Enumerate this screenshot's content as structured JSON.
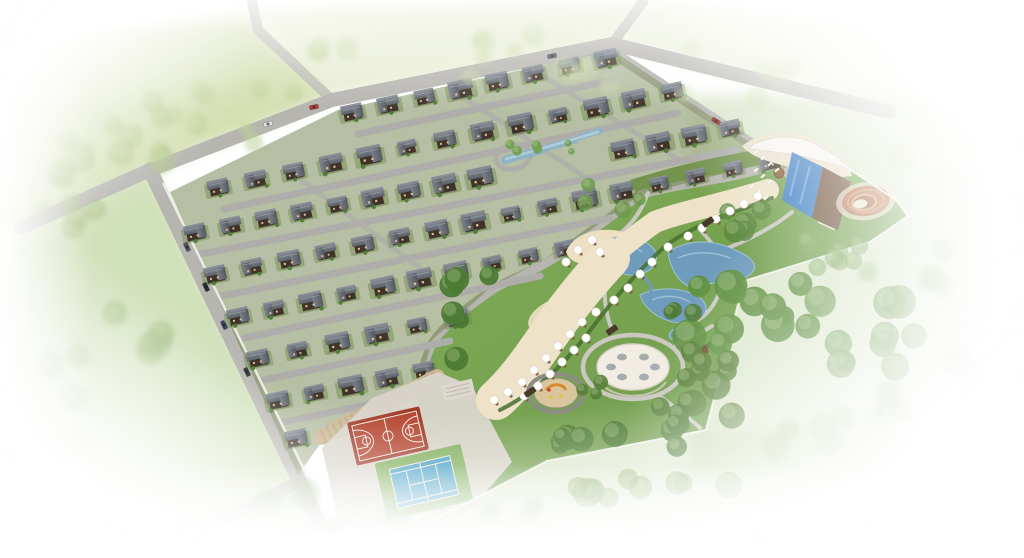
{
  "meta": {
    "title": "Aerial 3D rendering of a villa community masterplan",
    "view": "aerial-isometric",
    "description": "Gated residential estate of dark-roofed villas in diagonal rows, bounded by perimeter roads, with a landscaped park containing ponds, a sandy beach terrace with white umbrellas, a circular white plaza, a round children's playground, a swimming pool complex with wooden deck, a circular amphitheatre, a red basketball court and a blue tennis court; surrounded by green fields and tree belts fading to white at the edges."
  },
  "colors": {
    "background": "#ffffff",
    "field_green": "#ccdaa6",
    "field_green_top": "#d8e3b8",
    "meadow_green": "#aac685",
    "meadow_soft": "#b7cf92",
    "park_lawn": "#74a148",
    "park_lawn_dark": "#639140",
    "forest_green": "#5d8f3f",
    "tree_green_dark": "#4c7a33",
    "road_gray": "#b7b5b0",
    "street_gray": "#aeadaa",
    "path_gray": "#cac8c1",
    "wall_white": "#efeee8",
    "fence_white": "#f5f4ef",
    "estate_green": "#6d7f48",
    "yard_green": "#6c8a45",
    "house_body": "#3f332a",
    "window_cream": "#d8c49a",
    "roof_light": "#8e939b",
    "roof_dark": "#5c6169",
    "pond_blue": "#6f9cbd",
    "pond_blue_light": "#a9c9dc",
    "estate_pond": "#8fb3c6",
    "pool_blue": "#3e7ec2",
    "pool_lane": "#7db3e2",
    "deck_wood": "#6f5138",
    "deck_cream": "#ece2cc",
    "building_white": "#f6f4ee",
    "terrace_cream": "#eee3c8",
    "hedge_green": "#47702f",
    "sand_cream": "#ecdfc2",
    "court_red": "#b4432e",
    "court_red_dark": "#a23a28",
    "court_line": "#f2ece2",
    "tennis_blue": "#3f9dc4",
    "tennis_green": "#7fae5a",
    "platform_concrete": "#d8d4ca",
    "stone_wall_tan": "#cbb795",
    "stone_wall_dark": "#b3a07e",
    "amphitheater_brown": "#b5764f",
    "amphitheater_ring": "#c98f63",
    "amphitheater_inner": "#d8a97c",
    "amphitheater_center": "#ece5d6",
    "plaza_white": "#f1ede2",
    "plaza_detail": "#9aa0a6",
    "playground_sand": "#d9c69d",
    "playground_ring": "#8d8d85",
    "play_orange": "#d9882c",
    "play_yellow": "#e6c23a",
    "play_red": "#c0392b",
    "umbrella_white": "#ffffff",
    "table_brown": "#7a5a3a",
    "gazebo_brown": "#6b4f33"
  },
  "scene": {
    "house_rows": [
      {
        "x1": 352,
        "y1": 112,
        "x2": 606,
        "y2": 58,
        "n": 8,
        "gaps": []
      },
      {
        "x1": 218,
        "y1": 187,
        "x2": 672,
        "y2": 91,
        "n": 13,
        "gaps": []
      },
      {
        "x1": 195,
        "y1": 232,
        "x2": 730,
        "y2": 128,
        "n": 16,
        "gaps": [
          [
            488,
            615
          ]
        ]
      },
      {
        "x1": 215,
        "y1": 274,
        "x2": 770,
        "y2": 161,
        "n": 16,
        "gaps": []
      },
      {
        "x1": 238,
        "y1": 316,
        "x2": 565,
        "y2": 248,
        "n": 10,
        "gaps": []
      },
      {
        "x1": 258,
        "y1": 358,
        "x2": 457,
        "y2": 317,
        "n": 6,
        "gaps": []
      },
      {
        "x1": 278,
        "y1": 400,
        "x2": 424,
        "y2": 370,
        "n": 5,
        "gaps": []
      },
      {
        "x1": 296,
        "y1": 438,
        "x2": 380,
        "y2": 421,
        "n": 3,
        "gaps": []
      }
    ],
    "streets": [
      {
        "x1": 358,
        "y1": 134,
        "x2": 612,
        "y2": 80
      },
      {
        "x1": 224,
        "y1": 209,
        "x2": 678,
        "y2": 113
      },
      {
        "x1": 201,
        "y1": 254,
        "x2": 736,
        "y2": 150
      },
      {
        "x1": 221,
        "y1": 296,
        "x2": 610,
        "y2": 218
      },
      {
        "x1": 244,
        "y1": 338,
        "x2": 540,
        "y2": 276
      },
      {
        "x1": 264,
        "y1": 380,
        "x2": 450,
        "y2": 341
      },
      {
        "x1": 284,
        "y1": 422,
        "x2": 400,
        "y2": 398
      }
    ],
    "cross_streets": [
      {
        "x1": 452,
        "y1": 90,
        "x2": 590,
        "y2": 180
      },
      {
        "x1": 536,
        "y1": 72,
        "x2": 680,
        "y2": 160
      },
      {
        "x1": 296,
        "y1": 176,
        "x2": 420,
        "y2": 268
      }
    ],
    "tree_clusters": [
      {
        "x": 95,
        "y": 130,
        "n": 10,
        "sx": 80,
        "sy": 45,
        "rmin": 9,
        "rmax": 16,
        "color": "#aec487",
        "opacity": 0.55,
        "soft": true
      },
      {
        "x": 235,
        "y": 110,
        "n": 8,
        "sx": 70,
        "sy": 35,
        "rmin": 8,
        "rmax": 14,
        "color": "#bccf93",
        "opacity": 0.5,
        "soft": true
      },
      {
        "x": 55,
        "y": 205,
        "n": 7,
        "sx": 55,
        "sy": 35,
        "rmin": 8,
        "rmax": 14,
        "color": "#a3ba7c",
        "opacity": 0.5,
        "soft": true
      },
      {
        "x": 430,
        "y": 55,
        "n": 9,
        "sx": 120,
        "sy": 22,
        "rmin": 7,
        "rmax": 12,
        "color": "#c6d5a0",
        "opacity": 0.45,
        "soft": true
      },
      {
        "x": 710,
        "y": 70,
        "n": 10,
        "sx": 150,
        "sy": 30,
        "rmin": 8,
        "rmax": 13,
        "color": "#cdd9ab",
        "opacity": 0.4,
        "soft": true
      },
      {
        "x": 920,
        "y": 150,
        "n": 7,
        "sx": 80,
        "sy": 40,
        "rmin": 9,
        "rmax": 15,
        "color": "#c2d49c",
        "opacity": 0.35,
        "soft": true
      },
      {
        "x": 120,
        "y": 340,
        "n": 8,
        "sx": 70,
        "sy": 60,
        "rmin": 9,
        "rmax": 15,
        "color": "#9db97c",
        "opacity": 0.55,
        "soft": true
      },
      {
        "x": 70,
        "y": 440,
        "n": 6,
        "sx": 60,
        "sy": 45,
        "rmin": 9,
        "rmax": 15,
        "color": "#a5bf85",
        "opacity": 0.45,
        "soft": true
      },
      {
        "x": 745,
        "y": 320,
        "n": 12,
        "sx": 65,
        "sy": 42,
        "rmin": 10,
        "rmax": 18,
        "color": "#5d8f3f",
        "opacity": 0.92,
        "soft": false
      },
      {
        "x": 860,
        "y": 335,
        "n": 10,
        "sx": 55,
        "sy": 38,
        "rmin": 10,
        "rmax": 17,
        "color": "#679647",
        "opacity": 0.8,
        "soft": false
      },
      {
        "x": 940,
        "y": 385,
        "n": 7,
        "sx": 55,
        "sy": 35,
        "rmin": 10,
        "rmax": 16,
        "color": "#74a055",
        "opacity": 0.5,
        "soft": true
      },
      {
        "x": 700,
        "y": 395,
        "n": 7,
        "sx": 45,
        "sy": 30,
        "rmin": 9,
        "rmax": 15,
        "color": "#567f37",
        "opacity": 0.88,
        "soft": false
      },
      {
        "x": 815,
        "y": 255,
        "n": 7,
        "sx": 60,
        "sy": 25,
        "rmin": 8,
        "rmax": 13,
        "color": "#7da65c",
        "opacity": 0.6,
        "soft": false
      },
      {
        "x": 905,
        "y": 265,
        "n": 5,
        "sx": 40,
        "sy": 25,
        "rmin": 9,
        "rmax": 14,
        "color": "#85ad64",
        "opacity": 0.45,
        "soft": true
      },
      {
        "x": 468,
        "y": 305,
        "n": 6,
        "sx": 26,
        "sy": 55,
        "rmin": 8,
        "rmax": 13,
        "color": "#4c7a33",
        "opacity": 0.95,
        "soft": false
      },
      {
        "x": 556,
        "y": 432,
        "n": 5,
        "sx": 30,
        "sy": 18,
        "rmin": 8,
        "rmax": 13,
        "color": "#507d35",
        "opacity": 0.92,
        "soft": false
      },
      {
        "x": 648,
        "y": 428,
        "n": 6,
        "sx": 35,
        "sy": 20,
        "rmin": 8,
        "rmax": 14,
        "color": "#4c7a33",
        "opacity": 0.95,
        "soft": false
      },
      {
        "x": 708,
        "y": 357,
        "n": 4,
        "sx": 22,
        "sy": 16,
        "rmin": 7,
        "rmax": 11,
        "color": "#567f37",
        "opacity": 0.9,
        "soft": false
      },
      {
        "x": 733,
        "y": 225,
        "n": 5,
        "sx": 30,
        "sy": 18,
        "rmin": 7,
        "rmax": 12,
        "color": "#5c8a3e",
        "opacity": 0.85,
        "soft": false
      },
      {
        "x": 612,
        "y": 198,
        "n": 4,
        "sx": 28,
        "sy": 14,
        "rmin": 6,
        "rmax": 10,
        "color": "#6a984a",
        "opacity": 0.8,
        "soft": false
      },
      {
        "x": 676,
        "y": 308,
        "n": 3,
        "sx": 18,
        "sy": 12,
        "rmin": 6,
        "rmax": 9,
        "color": "#4c7a33",
        "opacity": 0.9,
        "soft": false
      },
      {
        "x": 590,
        "y": 390,
        "n": 3,
        "sx": 16,
        "sy": 10,
        "rmin": 5,
        "rmax": 8,
        "color": "#587f3a",
        "opacity": 0.9,
        "soft": false
      },
      {
        "x": 260,
        "y": 515,
        "n": 8,
        "sx": 80,
        "sy": 25,
        "rmin": 9,
        "rmax": 15,
        "color": "#8fae74",
        "opacity": 0.5,
        "soft": true
      },
      {
        "x": 475,
        "y": 528,
        "n": 8,
        "sx": 90,
        "sy": 22,
        "rmin": 9,
        "rmax": 15,
        "color": "#95b377",
        "opacity": 0.45,
        "soft": true
      },
      {
        "x": 655,
        "y": 472,
        "n": 9,
        "sx": 80,
        "sy": 28,
        "rmin": 9,
        "rmax": 16,
        "color": "#7ba257",
        "opacity": 0.6,
        "soft": false
      },
      {
        "x": 845,
        "y": 438,
        "n": 6,
        "sx": 70,
        "sy": 24,
        "rmin": 9,
        "rmax": 14,
        "color": "#86a968",
        "opacity": 0.4,
        "soft": true
      },
      {
        "x": 552,
        "y": 145,
        "n": 6,
        "sx": 45,
        "sy": 10,
        "rmin": 3,
        "rmax": 5,
        "color": "#6fa04b",
        "opacity": 0.9,
        "soft": false
      }
    ],
    "umbrellas": [
      [
        758,
        196
      ],
      [
        744,
        204
      ],
      [
        730,
        211
      ],
      [
        716,
        219
      ],
      [
        702,
        228
      ],
      [
        688,
        236
      ],
      [
        668,
        247
      ],
      [
        652,
        262
      ],
      [
        640,
        274
      ],
      [
        628,
        288
      ],
      [
        614,
        300
      ],
      [
        596,
        312
      ],
      [
        582,
        322
      ],
      [
        570,
        334
      ],
      [
        558,
        346
      ],
      [
        546,
        358
      ],
      [
        534,
        370
      ],
      [
        522,
        382
      ],
      [
        508,
        392
      ],
      [
        494,
        400
      ],
      [
        586,
        338
      ],
      [
        574,
        350
      ],
      [
        562,
        362
      ],
      [
        550,
        374
      ],
      [
        538,
        386
      ],
      [
        524,
        396
      ],
      [
        592,
        240
      ],
      [
        578,
        250
      ],
      [
        566,
        262
      ],
      [
        600,
        252
      ]
    ],
    "pergolas": [
      {
        "x": 708,
        "y": 222
      },
      {
        "x": 612,
        "y": 330
      },
      {
        "x": 530,
        "y": 392
      }
    ],
    "loungers": [
      [
        756,
        152
      ],
      [
        763,
        158
      ],
      [
        770,
        164
      ],
      [
        777,
        170
      ],
      [
        756,
        170
      ],
      [
        763,
        176
      ],
      [
        770,
        182
      ],
      [
        752,
        186
      ],
      [
        759,
        192
      ],
      [
        766,
        198
      ]
    ],
    "cars": [
      {
        "x": 314,
        "y": 107,
        "rot": -12,
        "color": "#b23b2c"
      },
      {
        "x": 268,
        "y": 124,
        "rot": -15,
        "color": "#e4e4e2"
      },
      {
        "x": 552,
        "y": 56,
        "rot": -11,
        "color": "#4a4f55"
      },
      {
        "x": 716,
        "y": 121,
        "rot": 33,
        "color": "#a03328"
      },
      {
        "x": 187,
        "y": 247,
        "rot": 64,
        "color": "#53585e"
      },
      {
        "x": 206,
        "y": 287,
        "rot": 64,
        "color": "#2c3036"
      },
      {
        "x": 224,
        "y": 325,
        "rot": 64,
        "color": "#3c4468"
      },
      {
        "x": 247,
        "y": 372,
        "rot": 64,
        "color": "#33363b"
      },
      {
        "x": 180,
        "y": 527,
        "rot": -17,
        "color": "#2f3338"
      }
    ]
  }
}
